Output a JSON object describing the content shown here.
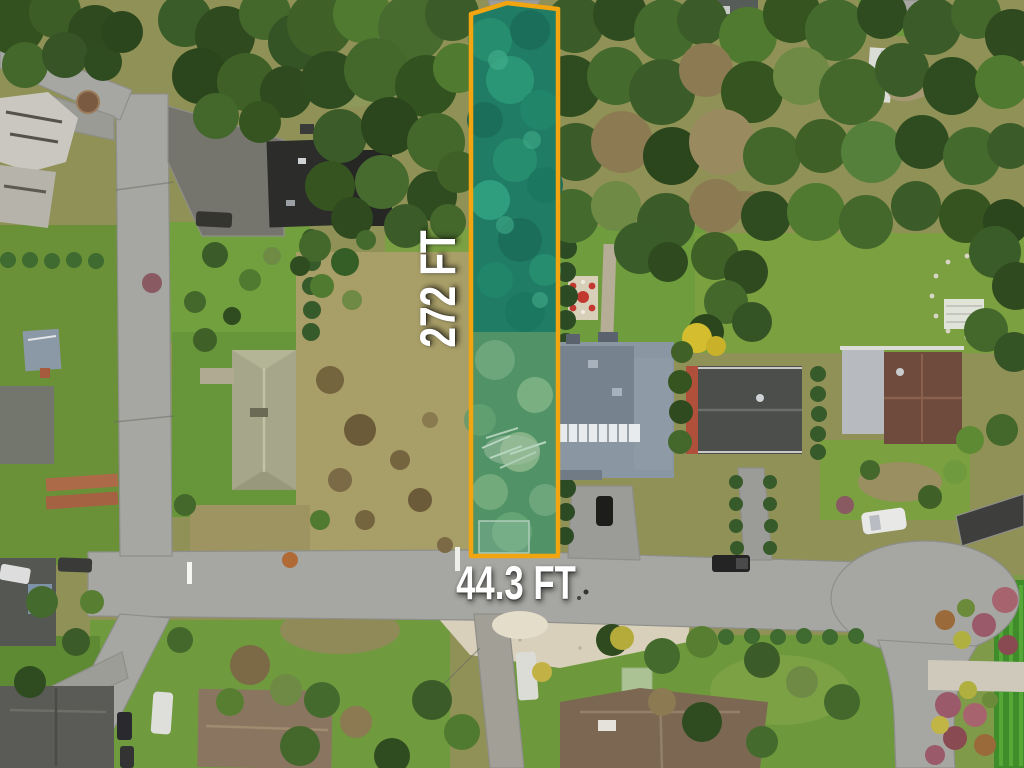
{
  "annotations": {
    "lot_depth": "272 FT",
    "lot_width": "44.3 FT"
  },
  "colors": {
    "boundary": "#F0A511",
    "lot_tint": "rgba(30,185,145,0.18)",
    "label": "#FFFFFF"
  }
}
